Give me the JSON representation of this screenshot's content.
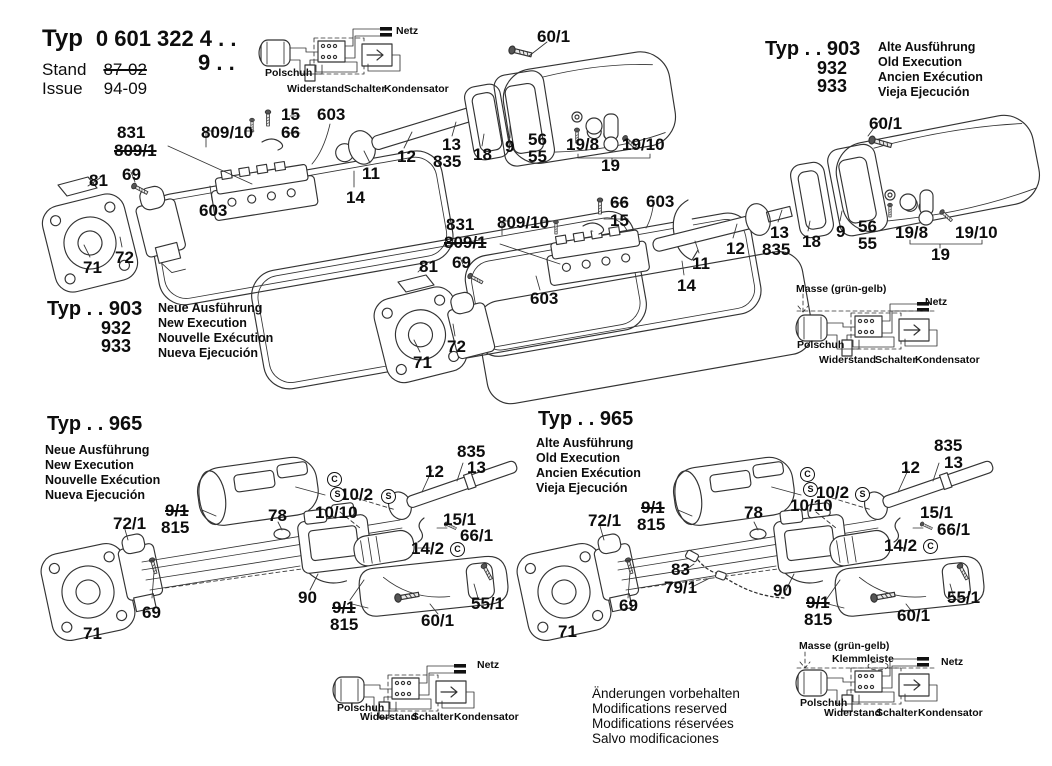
{
  "header": {
    "typ_label": "Typ",
    "typ_number": "0 601 322",
    "suffix_line1": "4 . .",
    "suffix_line2": "9 . .",
    "stand_label": "Stand",
    "stand_value": "87-02",
    "issue_label": "Issue",
    "issue_value": "94-09"
  },
  "type_blocks": {
    "t903_old": {
      "title": "Typ . . 903",
      "variants": [
        "932",
        "933"
      ],
      "lines": [
        "Alte Ausführung",
        "Old Execution",
        "Ancien Exécution",
        "Vieja Ejecución"
      ]
    },
    "t903_new": {
      "title": "Typ . . 903",
      "variants": [
        "932",
        "933"
      ],
      "lines": [
        "Neue Ausführung",
        "New Execution",
        "Nouvelle Exécution",
        "Nueva Ejecución"
      ]
    },
    "t965_new": {
      "title": "Typ . . 965",
      "lines": [
        "Neue Ausführung",
        "New Execution",
        "Nouvelle Exécution",
        "Nueva Ejecución"
      ]
    },
    "t965_old": {
      "title": "Typ . . 965",
      "lines": [
        "Alte Ausführung",
        "Old Execution",
        "Ancien Exécution",
        "Vieja Ejecución"
      ]
    }
  },
  "footer": {
    "lines": [
      "Änderungen vorbehalten",
      "Modifications reserved",
      "Modifications réservées",
      "Salvo modificaciones"
    ]
  },
  "annotations": [
    {
      "t": "831",
      "x": 117,
      "y": 124,
      "k": "part"
    },
    {
      "t": "809/1",
      "x": 114,
      "y": 142,
      "k": "part",
      "strike": true
    },
    {
      "t": "809/10",
      "x": 201,
      "y": 124,
      "k": "part"
    },
    {
      "t": "15",
      "x": 281,
      "y": 106,
      "k": "part"
    },
    {
      "t": "66",
      "x": 281,
      "y": 124,
      "k": "part"
    },
    {
      "t": "603",
      "x": 317,
      "y": 106,
      "k": "part"
    },
    {
      "t": "12",
      "x": 397,
      "y": 148,
      "k": "part"
    },
    {
      "t": "13",
      "x": 442,
      "y": 136,
      "k": "part"
    },
    {
      "t": "835",
      "x": 433,
      "y": 153,
      "k": "part"
    },
    {
      "t": "18",
      "x": 473,
      "y": 146,
      "k": "part"
    },
    {
      "t": "9",
      "x": 505,
      "y": 138,
      "k": "part"
    },
    {
      "t": "56",
      "x": 528,
      "y": 131,
      "k": "part"
    },
    {
      "t": "55",
      "x": 528,
      "y": 148,
      "k": "part"
    },
    {
      "t": "19/8",
      "x": 566,
      "y": 136,
      "k": "part"
    },
    {
      "t": "19/10",
      "x": 622,
      "y": 136,
      "k": "part"
    },
    {
      "t": "19",
      "x": 601,
      "y": 157,
      "k": "part"
    },
    {
      "t": "60/1",
      "x": 537,
      "y": 28,
      "k": "part"
    },
    {
      "t": "11",
      "x": 362,
      "y": 165,
      "k": "part"
    },
    {
      "t": "14",
      "x": 346,
      "y": 189,
      "k": "part"
    },
    {
      "t": "603",
      "x": 199,
      "y": 202,
      "k": "part"
    },
    {
      "t": "81",
      "x": 89,
      "y": 172,
      "k": "part"
    },
    {
      "t": "69",
      "x": 122,
      "y": 166,
      "k": "part"
    },
    {
      "t": "72",
      "x": 115,
      "y": 249,
      "k": "part"
    },
    {
      "t": "71",
      "x": 83,
      "y": 259,
      "k": "part"
    },
    {
      "t": "831",
      "x": 446,
      "y": 216,
      "k": "part"
    },
    {
      "t": "809/1",
      "x": 444,
      "y": 234,
      "k": "part",
      "strike": true
    },
    {
      "t": "809/10",
      "x": 497,
      "y": 214,
      "k": "part"
    },
    {
      "t": "66",
      "x": 610,
      "y": 194,
      "k": "part"
    },
    {
      "t": "15",
      "x": 610,
      "y": 212,
      "k": "part"
    },
    {
      "t": "603",
      "x": 646,
      "y": 193,
      "k": "part"
    },
    {
      "t": "12",
      "x": 726,
      "y": 240,
      "k": "part"
    },
    {
      "t": "11",
      "x": 692,
      "y": 255,
      "k": "part"
    },
    {
      "t": "14",
      "x": 677,
      "y": 277,
      "k": "part"
    },
    {
      "t": "81",
      "x": 419,
      "y": 258,
      "k": "part"
    },
    {
      "t": "69",
      "x": 452,
      "y": 254,
      "k": "part"
    },
    {
      "t": "603",
      "x": 530,
      "y": 290,
      "k": "part"
    },
    {
      "t": "72",
      "x": 447,
      "y": 338,
      "k": "part"
    },
    {
      "t": "71",
      "x": 413,
      "y": 354,
      "k": "part"
    },
    {
      "t": "60/1",
      "x": 869,
      "y": 115,
      "k": "part"
    },
    {
      "t": "13",
      "x": 770,
      "y": 224,
      "k": "part"
    },
    {
      "t": "835",
      "x": 762,
      "y": 241,
      "k": "part"
    },
    {
      "t": "18",
      "x": 802,
      "y": 233,
      "k": "part"
    },
    {
      "t": "9",
      "x": 836,
      "y": 223,
      "k": "part"
    },
    {
      "t": "56",
      "x": 858,
      "y": 218,
      "k": "part"
    },
    {
      "t": "55",
      "x": 858,
      "y": 235,
      "k": "part"
    },
    {
      "t": "19/8",
      "x": 895,
      "y": 224,
      "k": "part"
    },
    {
      "t": "19/10",
      "x": 955,
      "y": 224,
      "k": "part"
    },
    {
      "t": "19",
      "x": 931,
      "y": 246,
      "k": "part"
    },
    {
      "t": "72/1",
      "x": 113,
      "y": 515,
      "k": "part"
    },
    {
      "t": "9/1",
      "x": 165,
      "y": 502,
      "k": "part",
      "strike": true
    },
    {
      "t": "815",
      "x": 161,
      "y": 519,
      "k": "part"
    },
    {
      "t": "78",
      "x": 268,
      "y": 507,
      "k": "part"
    },
    {
      "t": "10/2",
      "x": 340,
      "y": 486,
      "k": "part"
    },
    {
      "t": "S",
      "x": 381,
      "y": 489,
      "k": "circ"
    },
    {
      "t": "10/10",
      "x": 315,
      "y": 504,
      "k": "part"
    },
    {
      "t": "C",
      "x": 327,
      "y": 472,
      "k": "circ"
    },
    {
      "t": "S",
      "x": 330,
      "y": 487,
      "k": "circ"
    },
    {
      "t": "90",
      "x": 298,
      "y": 589,
      "k": "part"
    },
    {
      "t": "9/1",
      "x": 332,
      "y": 599,
      "k": "part",
      "strike": true
    },
    {
      "t": "815",
      "x": 330,
      "y": 616,
      "k": "part"
    },
    {
      "t": "69",
      "x": 142,
      "y": 604,
      "k": "part"
    },
    {
      "t": "71",
      "x": 83,
      "y": 625,
      "k": "part"
    },
    {
      "t": "12",
      "x": 425,
      "y": 463,
      "k": "part"
    },
    {
      "t": "835",
      "x": 457,
      "y": 443,
      "k": "part"
    },
    {
      "t": "13",
      "x": 467,
      "y": 459,
      "k": "part"
    },
    {
      "t": "15/1",
      "x": 443,
      "y": 511,
      "k": "part"
    },
    {
      "t": "66/1",
      "x": 460,
      "y": 527,
      "k": "part"
    },
    {
      "t": "14/2",
      "x": 411,
      "y": 540,
      "k": "part"
    },
    {
      "t": "C",
      "x": 450,
      "y": 542,
      "k": "circ"
    },
    {
      "t": "55/1",
      "x": 471,
      "y": 595,
      "k": "part"
    },
    {
      "t": "60/1",
      "x": 421,
      "y": 612,
      "k": "part"
    },
    {
      "t": "72/1",
      "x": 588,
      "y": 512,
      "k": "part"
    },
    {
      "t": "9/1",
      "x": 641,
      "y": 499,
      "k": "part",
      "strike": true
    },
    {
      "t": "815",
      "x": 637,
      "y": 516,
      "k": "part"
    },
    {
      "t": "78",
      "x": 744,
      "y": 504,
      "k": "part"
    },
    {
      "t": "10/10",
      "x": 790,
      "y": 497,
      "k": "part"
    },
    {
      "t": "10/2",
      "x": 816,
      "y": 484,
      "k": "part"
    },
    {
      "t": "S",
      "x": 855,
      "y": 487,
      "k": "circ"
    },
    {
      "t": "C",
      "x": 800,
      "y": 467,
      "k": "circ"
    },
    {
      "t": "S",
      "x": 803,
      "y": 482,
      "k": "circ"
    },
    {
      "t": "83",
      "x": 671,
      "y": 561,
      "k": "part"
    },
    {
      "t": "79/1",
      "x": 664,
      "y": 579,
      "k": "part"
    },
    {
      "t": "90",
      "x": 773,
      "y": 582,
      "k": "part"
    },
    {
      "t": "9/1",
      "x": 806,
      "y": 594,
      "k": "part",
      "strike": true
    },
    {
      "t": "815",
      "x": 804,
      "y": 611,
      "k": "part"
    },
    {
      "t": "69",
      "x": 619,
      "y": 597,
      "k": "part"
    },
    {
      "t": "71",
      "x": 558,
      "y": 623,
      "k": "part"
    },
    {
      "t": "12",
      "x": 901,
      "y": 459,
      "k": "part"
    },
    {
      "t": "835",
      "x": 934,
      "y": 437,
      "k": "part"
    },
    {
      "t": "13",
      "x": 944,
      "y": 454,
      "k": "part"
    },
    {
      "t": "15/1",
      "x": 920,
      "y": 504,
      "k": "part"
    },
    {
      "t": "66/1",
      "x": 937,
      "y": 521,
      "k": "part"
    },
    {
      "t": "14/2",
      "x": 884,
      "y": 537,
      "k": "part"
    },
    {
      "t": "C",
      "x": 923,
      "y": 539,
      "k": "circ"
    },
    {
      "t": "55/1",
      "x": 947,
      "y": 589,
      "k": "part"
    },
    {
      "t": "60/1",
      "x": 897,
      "y": 607,
      "k": "part"
    },
    {
      "t": "Netz",
      "x": 396,
      "y": 26,
      "k": "sch"
    },
    {
      "t": "Polschuh",
      "x": 265,
      "y": 68,
      "k": "sch"
    },
    {
      "t": "Widerstand",
      "x": 287,
      "y": 84,
      "k": "sch"
    },
    {
      "t": "Schalter",
      "x": 344,
      "y": 84,
      "k": "sch"
    },
    {
      "t": "Kondensator",
      "x": 384,
      "y": 84,
      "k": "sch"
    },
    {
      "t": "Masse (grün-gelb)",
      "x": 796,
      "y": 284,
      "k": "sch"
    },
    {
      "t": "Netz",
      "x": 925,
      "y": 297,
      "k": "sch"
    },
    {
      "t": "Polschuh",
      "x": 797,
      "y": 340,
      "k": "sch"
    },
    {
      "t": "Widerstand",
      "x": 819,
      "y": 355,
      "k": "sch"
    },
    {
      "t": "Schalter",
      "x": 875,
      "y": 355,
      "k": "sch"
    },
    {
      "t": "Kondensator",
      "x": 915,
      "y": 355,
      "k": "sch"
    },
    {
      "t": "Netz",
      "x": 477,
      "y": 660,
      "k": "sch"
    },
    {
      "t": "Polschuh",
      "x": 337,
      "y": 703,
      "k": "sch"
    },
    {
      "t": "Widerstand",
      "x": 360,
      "y": 712,
      "k": "sch"
    },
    {
      "t": "Schalter",
      "x": 412,
      "y": 712,
      "k": "sch"
    },
    {
      "t": "Kondensator",
      "x": 454,
      "y": 712,
      "k": "sch"
    },
    {
      "t": "Masse (grün-gelb)",
      "x": 799,
      "y": 641,
      "k": "sch"
    },
    {
      "t": "Klemmleiste",
      "x": 832,
      "y": 654,
      "k": "sch"
    },
    {
      "t": "Netz",
      "x": 941,
      "y": 657,
      "k": "sch"
    },
    {
      "t": "Polschuh",
      "x": 800,
      "y": 698,
      "k": "sch"
    },
    {
      "t": "Widerstand",
      "x": 824,
      "y": 708,
      "k": "sch"
    },
    {
      "t": "Schalter",
      "x": 876,
      "y": 708,
      "k": "sch"
    },
    {
      "t": "Kondensator",
      "x": 918,
      "y": 708,
      "k": "sch"
    }
  ]
}
